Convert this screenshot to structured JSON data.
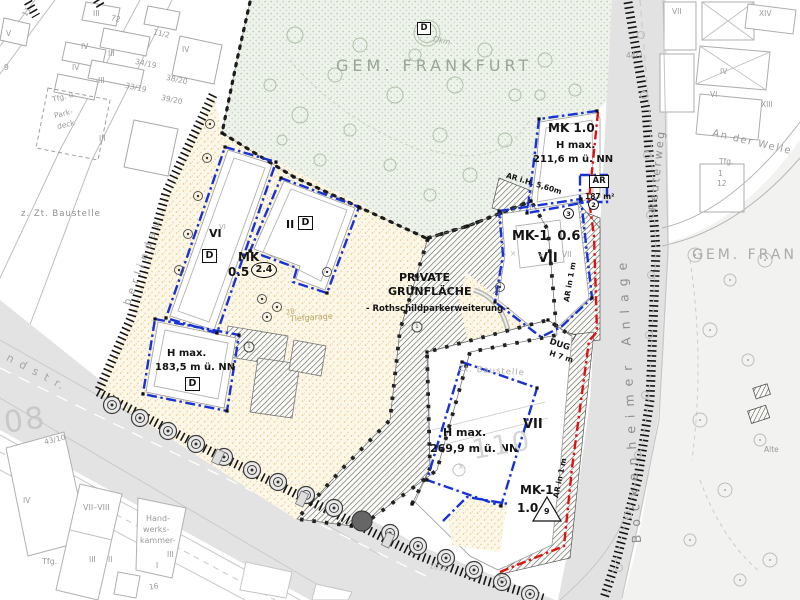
{
  "map": {
    "region_labels": {
      "gem_frankfurt_top": "GEM. FRANKFURT",
      "gem_frankfurt_right": "GEM. FRAN",
      "private_green_1": "PRIVATE",
      "private_green_2": "GRÜNFLÄCHE",
      "private_green_3": "- Rothschildparkerweiterung -"
    },
    "streets": {
      "bockenheimer_anlage": "B o c k e n h e i m e r   A n l a g e",
      "reuterweg": "Reuterweg",
      "an_der_welle": "An der Welle",
      "landstrasse_fragment": "n d s t r.",
      "oberlindau_fragment": "b e r l i n d a u"
    },
    "zoning": {
      "mk_top_right": {
        "name": "MK 1.0",
        "h_max_label": "H max.",
        "h_max_value": "211,6 m ü. NN",
        "ar_label": "AR",
        "ar_area": "187 m²",
        "ar_note": "AR i.H. 5,60m",
        "circle_2": "2",
        "circle_3": "3"
      },
      "mk_mid_right": {
        "name": "MK-1  0.6",
        "storeys": "VII",
        "ar_note": "AR in 1 m"
      },
      "mk_left": {
        "name": "MK",
        "value": "0.5",
        "gfz": "2.4",
        "storeys_a": "VI",
        "storeys_b": "II",
        "d_a": "D",
        "d_b": "D"
      },
      "h_max_left": {
        "label": "H max.",
        "value": "183,5 m ü. NN",
        "d": "D"
      },
      "h_max_bottom": {
        "label": "H max.",
        "value": "269,9 m ü. NN",
        "storeys": "VII"
      },
      "mk_bottom": {
        "name": "MK-1",
        "value": "1.0",
        "triangle": "9",
        "ar_note": "AR in 1 m"
      },
      "dug": {
        "name": "DUG",
        "height": "H 7 m"
      }
    },
    "annotations": {
      "construction_left": "z. Zt. Baustelle",
      "construction_right": "Zt. Baustelle",
      "tiefgarage": "Tiefgarage",
      "monument": {
        "d": "D",
        "label": "Dkm"
      }
    },
    "cadastre": {
      "big_left": "08",
      "big_center": "110"
    },
    "micro_labels": [
      {
        "t": "III",
        "x": 93,
        "y": 10
      },
      {
        "t": "72",
        "x": 111,
        "y": 15,
        "r": 12
      },
      {
        "t": "11/2",
        "x": 153,
        "y": 30,
        "r": 12
      },
      {
        "t": "IV",
        "x": 81,
        "y": 43
      },
      {
        "t": "III",
        "x": 108,
        "y": 50
      },
      {
        "t": "IV",
        "x": 182,
        "y": 46
      },
      {
        "t": "34/19",
        "x": 135,
        "y": 60,
        "r": 12
      },
      {
        "t": "IV",
        "x": 72,
        "y": 64
      },
      {
        "t": "38/20",
        "x": 166,
        "y": 76,
        "r": 12
      },
      {
        "t": "III",
        "x": 98,
        "y": 77
      },
      {
        "t": "33/19",
        "x": 125,
        "y": 84,
        "r": 12
      },
      {
        "t": "39/20",
        "x": 161,
        "y": 96,
        "r": 12
      },
      {
        "t": "Tfg. u.",
        "x": 52,
        "y": 93,
        "r": -14
      },
      {
        "t": "Park-",
        "x": 54,
        "y": 110,
        "r": -14
      },
      {
        "t": "deck",
        "x": 57,
        "y": 121,
        "r": -14
      },
      {
        "t": "III",
        "x": 99,
        "y": 135
      },
      {
        "t": "V",
        "x": 6,
        "y": 30
      },
      {
        "t": "11",
        "x": 22,
        "y": 8,
        "r": -60
      },
      {
        "t": "9",
        "x": 4,
        "y": 64
      },
      {
        "t": "43/10",
        "x": 44,
        "y": 436,
        "r": -14
      },
      {
        "t": "IV",
        "x": 23,
        "y": 497
      },
      {
        "t": "VII–VIII",
        "x": 83,
        "y": 504,
        "s": 8
      },
      {
        "t": "Hand-",
        "x": 146,
        "y": 515,
        "s": 8
      },
      {
        "t": "werks-",
        "x": 143,
        "y": 526,
        "s": 8
      },
      {
        "t": "kammer-",
        "x": 140,
        "y": 537,
        "s": 8
      },
      {
        "t": "III",
        "x": 167,
        "y": 551
      },
      {
        "t": "I",
        "x": 156,
        "y": 562
      },
      {
        "t": "Tfg.",
        "x": 42,
        "y": 558,
        "s": 8
      },
      {
        "t": "III",
        "x": 89,
        "y": 556
      },
      {
        "t": "II",
        "x": 108,
        "y": 556
      },
      {
        "t": "16",
        "x": 149,
        "y": 583,
        "r": -10
      },
      {
        "t": "1015",
        "x": 429,
        "y": 564,
        "r": 11,
        "c": "#b8b8b8"
      },
      {
        "t": "15",
        "x": 497,
        "y": 575,
        "r": 11
      },
      {
        "t": "VII",
        "x": 672,
        "y": 8
      },
      {
        "t": "XIV",
        "x": 759,
        "y": 10
      },
      {
        "t": "44/2",
        "x": 626,
        "y": 52
      },
      {
        "t": "IV",
        "x": 720,
        "y": 68
      },
      {
        "t": "VI",
        "x": 710,
        "y": 91
      },
      {
        "t": "XIII",
        "x": 761,
        "y": 101
      },
      {
        "t": "Tfg.",
        "x": 719,
        "y": 158
      },
      {
        "t": "1",
        "x": 718,
        "y": 170
      },
      {
        "t": "12",
        "x": 717,
        "y": 180
      },
      {
        "t": "Alte",
        "x": 764,
        "y": 446
      },
      {
        "t": "VII",
        "x": 562,
        "y": 251,
        "c": "#a0a0a0"
      },
      {
        "t": "VI",
        "x": 219,
        "y": 224,
        "s": 7,
        "c": "#a8a8a8"
      },
      {
        "t": "×",
        "x": 510,
        "y": 250,
        "c": "#bbb"
      },
      {
        "t": "×",
        "x": 538,
        "y": 252,
        "c": "#bbb"
      },
      {
        "t": "×",
        "x": 458,
        "y": 463,
        "c": "#bbb"
      },
      {
        "t": "28",
        "x": 286,
        "y": 309,
        "s": 7,
        "c": "#b9a76b",
        "r": -10
      },
      {
        "t": "1",
        "x": 415,
        "y": 324,
        "s": 6,
        "c": "#555"
      },
      {
        "t": "1",
        "x": 247,
        "y": 344,
        "s": 6,
        "c": "#555"
      }
    ]
  }
}
